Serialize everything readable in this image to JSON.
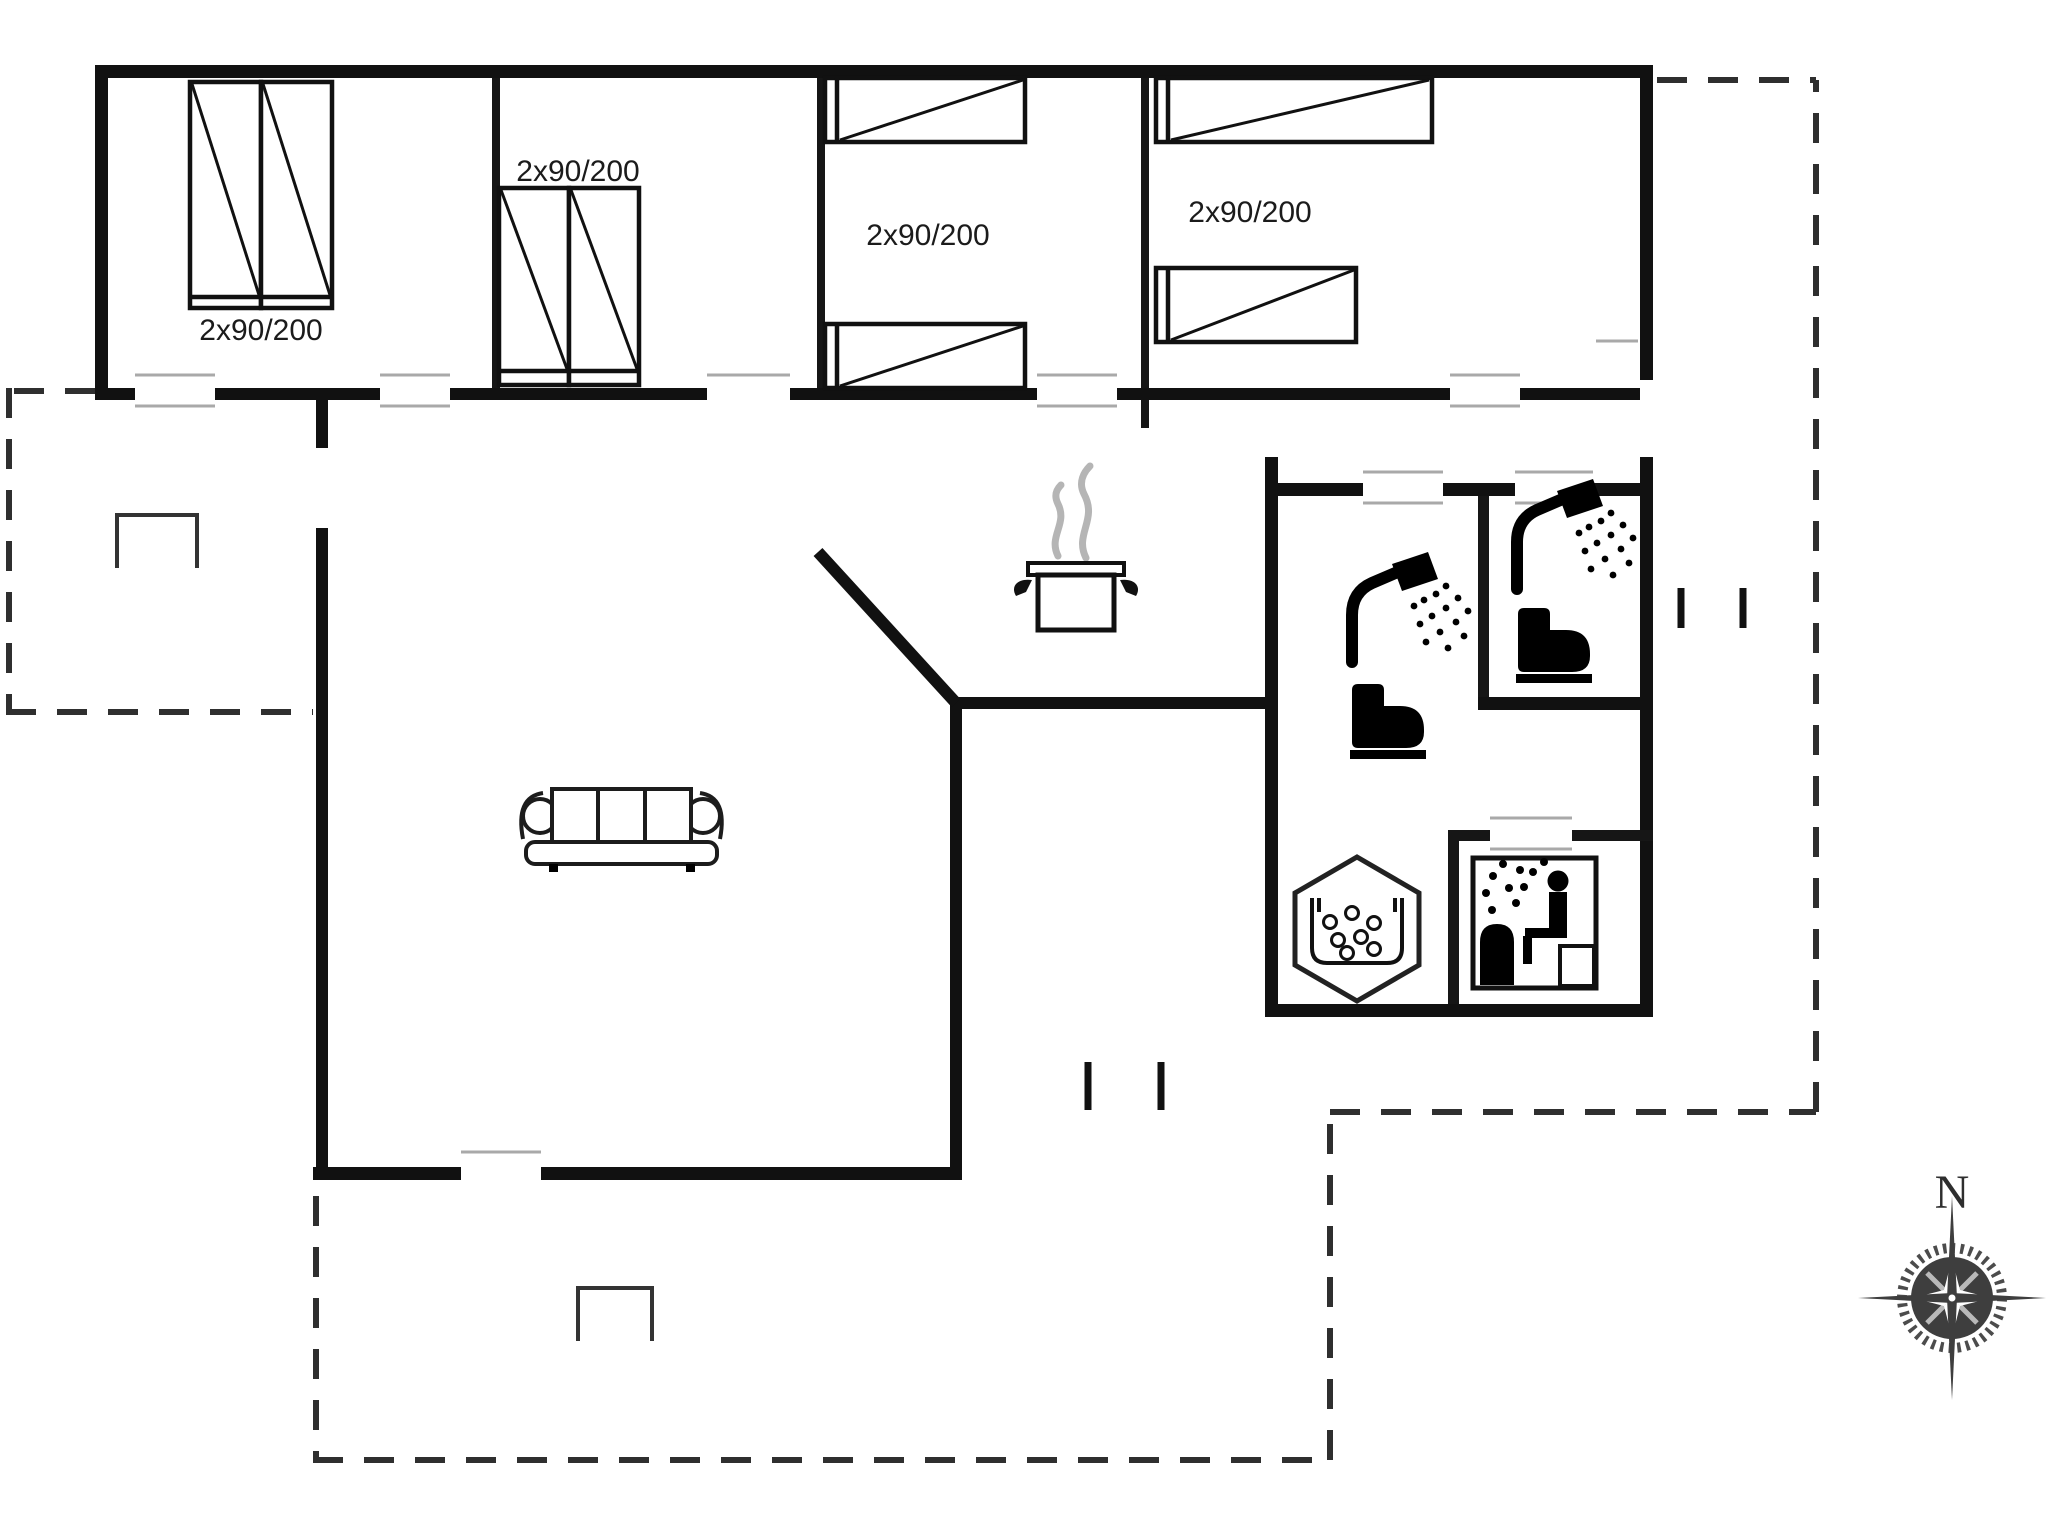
{
  "plan": {
    "type": "holiday-house floor plan",
    "compass": {
      "north_label": "N"
    }
  },
  "bedrooms": [
    {
      "id": "bedroom-1",
      "bed_label": "2x90/200"
    },
    {
      "id": "bedroom-2",
      "bed_label": "2x90/200"
    },
    {
      "id": "bedroom-3",
      "bed_label": "2x90/200"
    },
    {
      "id": "bedroom-4",
      "bed_label": "2x90/200"
    }
  ],
  "icons": {
    "stove": "pot-with-steam",
    "sofa": "three-seat-sofa",
    "shower": "shower-head-with-spray",
    "toilet": "toilet-silhouette",
    "whirlpool": "hexagon-bubble-tub",
    "sauna": "sauna-person-with-steam",
    "grill": "open-rectangle-marker",
    "steps": "double-tick-entrance",
    "compass": "compass-rose"
  },
  "colors": {
    "wall": "#111111",
    "door_line": "#a9a9a9",
    "terrace_dash": "#2f2f2f",
    "steam": "#b5b5b5",
    "compass_disc": "#3e3e3e"
  }
}
